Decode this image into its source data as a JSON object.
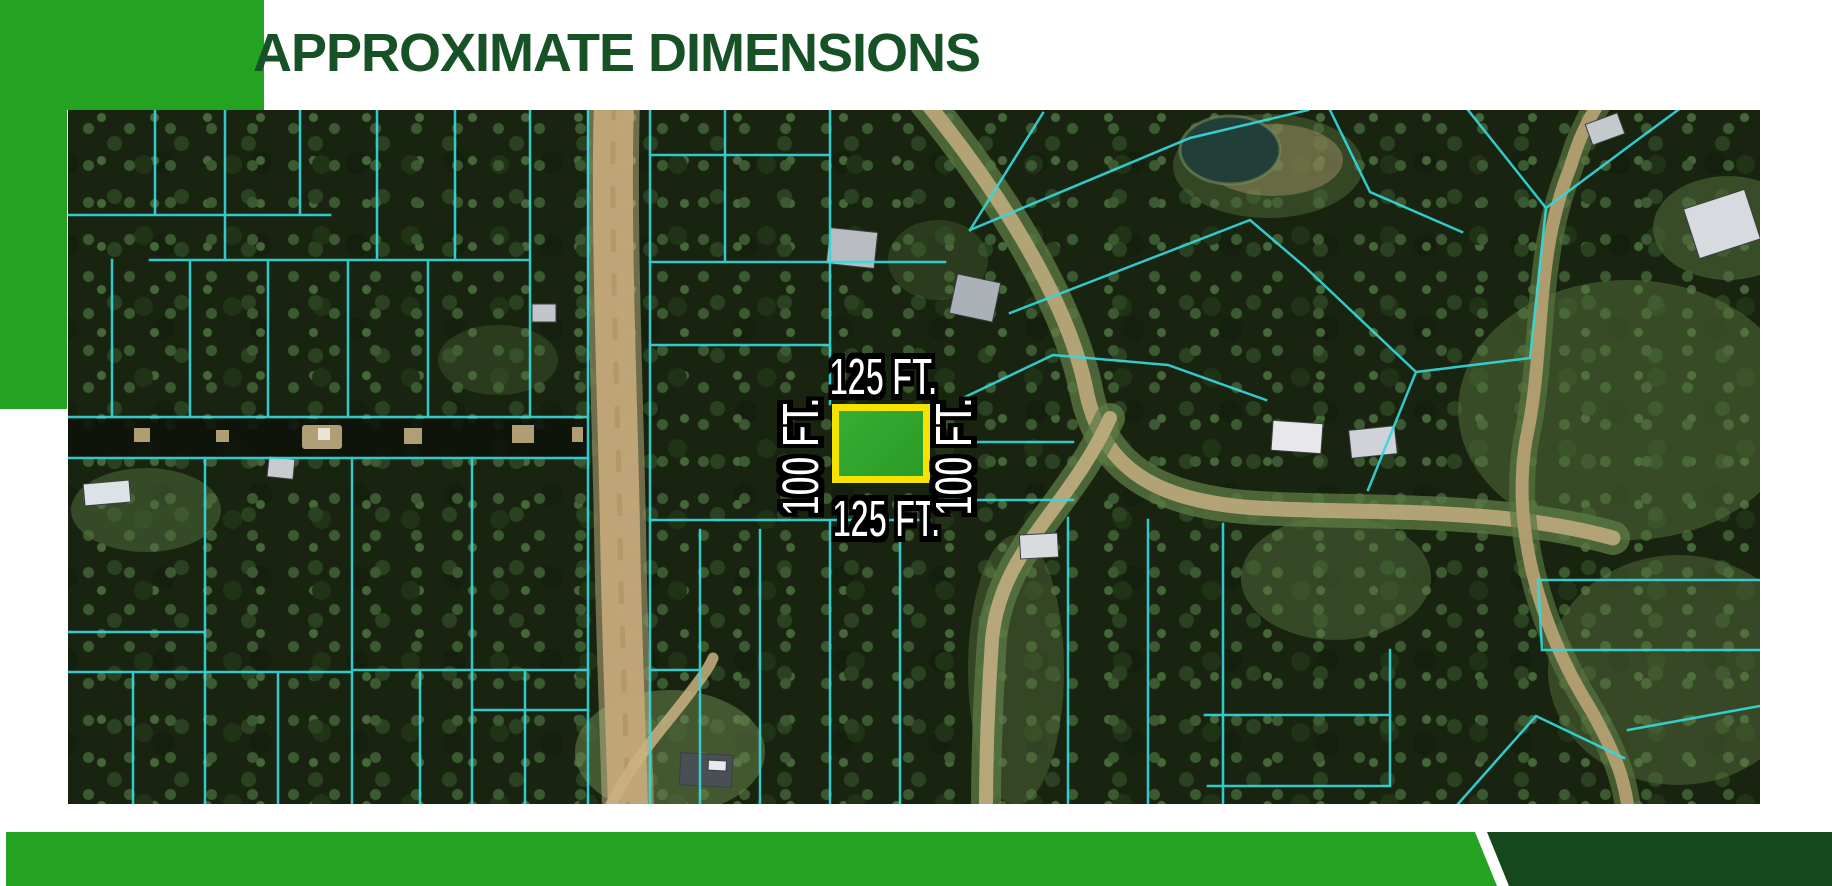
{
  "slide": {
    "title": "APPROXIMATE DIMENSIONS"
  },
  "map": {
    "kind": "aerial-parcel-map",
    "highlighted_parcel": {
      "top_label": "125 FT.",
      "right_label": "100 FT.",
      "bottom_label": "125 FT.",
      "left_label": "100 FT."
    }
  },
  "colors": {
    "accent_green": "#23A321",
    "footer_dark_green": "#15491D",
    "title_green": "#175126",
    "parcel_line_cyan": "#36D8DC",
    "highlight_border": "#F6E400",
    "highlight_fill": "#2FA42C",
    "dimension_text": "#FFFFFF",
    "dimension_outline": "#000000"
  }
}
